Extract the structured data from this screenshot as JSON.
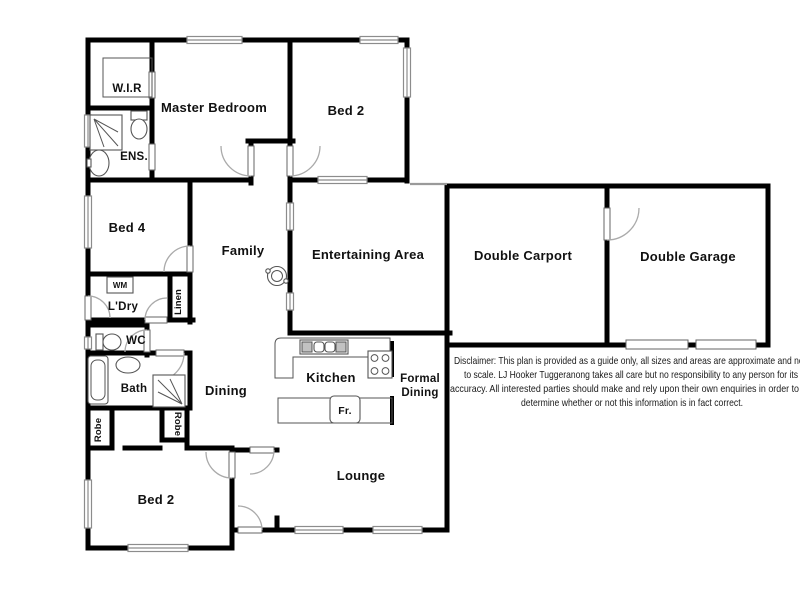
{
  "plan": {
    "labels": {
      "wir": "W.I.R",
      "master": "Master Bedroom",
      "bed2_top": "Bed 2",
      "ens": "ENS.",
      "bed4": "Bed 4",
      "family": "Family",
      "entertaining": "Entertaining Area",
      "carport": "Double Carport",
      "garage": "Double Garage",
      "ldry": "L'Dry",
      "linen": "Linen",
      "wm": "WM",
      "wc": "WC",
      "bath": "Bath",
      "dining": "Dining",
      "kitchen": "Kitchen",
      "formal_line1": "Formal",
      "formal_line2": "Dining",
      "robe_left": "Robe",
      "robe_right": "Robe",
      "fridge": "Fr.",
      "lounge": "Lounge",
      "bed2_bottom": "Bed 2"
    },
    "disclaimer": {
      "line1": "Disclaimer: This plan is provided as a guide only, all sizes and areas are approximate and not",
      "line2": "to scale. LJ Hooker Tuggeranong takes all care but no responsibility to any person for its",
      "line3": "accuracy. All interested parties should make and rely upon their own enquiries in order to",
      "line4": "determine whether or not this information is in fact correct."
    },
    "colors": {
      "wall": "#000000",
      "window": "#8c8c8c",
      "door_arc": "#aaaaaa",
      "background": "#ffffff"
    }
  }
}
